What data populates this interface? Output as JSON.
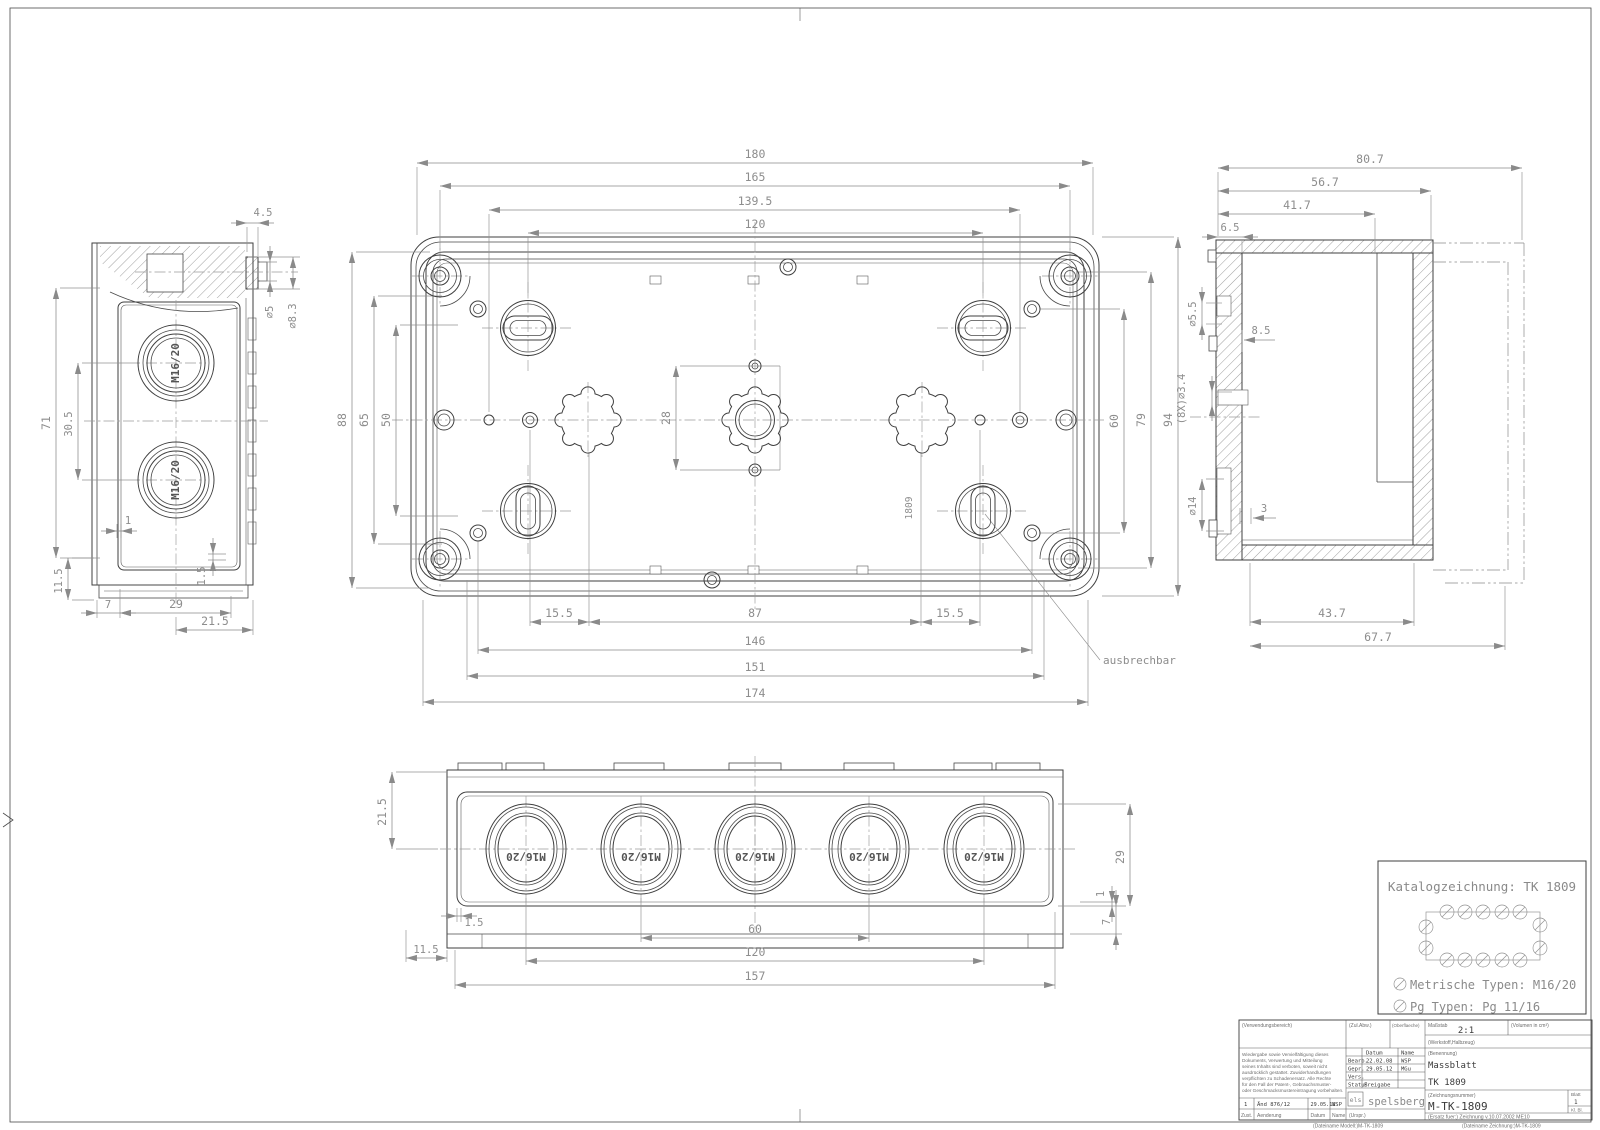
{
  "drawing_type": "dimensioned technical drawing (Massblatt) of enclosure TK 1809",
  "dims": {
    "tv_180": "180",
    "tv_165": "165",
    "tv_139_5": "139.5",
    "tv_120": "120",
    "tv_88": "88",
    "tv_65": "65",
    "tv_50": "50",
    "tv_28": "28",
    "tv_60": "60",
    "tv_79": "79",
    "tv_94": "94",
    "tv_15_5a": "15.5",
    "tv_87": "87",
    "tv_15_5b": "15.5",
    "tv_146": "146",
    "tv_151": "151",
    "tv_174": "174",
    "lv_4_5": "4.5",
    "lv_dia5": "∅5",
    "lv_dia8_3": "∅8.3",
    "lv_71": "71",
    "lv_30_5": "30.5",
    "lv_1": "1",
    "lv_1_5": "1.5",
    "lv_11_5": "11.5",
    "lv_7": "7",
    "lv_29": "29",
    "lv_21_5": "21.5",
    "rv_80_7": "80.7",
    "rv_56_7": "56.7",
    "rv_41_7": "41.7",
    "rv_6_5": "6.5",
    "rv_dia5_5": "∅5.5",
    "rv_8_5": "8.5",
    "rv_dia3_4": "(8X)∅3.4",
    "rv_dia14": "∅14",
    "rv_3": "3",
    "rv_43_7": "43.7",
    "rv_67_7": "67.7",
    "bv_21_5": "21.5",
    "bv_29": "29",
    "bv_1": "1",
    "bv_7": "7",
    "bv_1_5": "1.5",
    "bv_11_5": "11.5",
    "bv_60": "60",
    "bv_120": "120",
    "bv_157": "157"
  },
  "labels": {
    "m16": "M16/20",
    "ausbrechbar": "ausbrechbar",
    "stamp": "1809"
  },
  "catalog": {
    "title": "Katalogzeichnung: TK 1809",
    "metric": "Metrische Typen: M16/20",
    "pg": "Pg Typen: Pg 11/16"
  },
  "tb": {
    "verwendungsbereich": "(Verwendungsbereich)",
    "zul_abw": "(Zul.Abw.)",
    "oberflaeche": "(Oberflaeche)",
    "massstab_label": "Maßstab",
    "massstab_value": "2:1",
    "volumen": "(Volumen in cm³)",
    "werkstoff": "(Werkstoff,Halbzeug)",
    "legal": [
      "Wiedergabe sowie Vervielfältigung dieses",
      "Dokuments, Verwertung und Mitteilung",
      "seines Inhalts sind verboten, soweit nicht",
      "ausdrücklich gestattet. Zuwiderhandlungen",
      "verpflichten zu Schadenersatz. Alle Rechte",
      "für den Fall der Patent-, Gebrauchsmuster-",
      "oder Geschmacksmustereintragung vorbehalten."
    ],
    "datum_h": "Datum",
    "name_h": "Name",
    "bearb": "Bearb.",
    "bearb_datum": "22.02.08",
    "bearb_name": "WSP",
    "gepr": "Gepr.",
    "gepr_datum": "29.05.12",
    "gepr_name": "MGu",
    "vers": "Vers.",
    "status": "Status",
    "freigabe": "Freigabe",
    "logo_mark": "els",
    "logo": "spelsberg",
    "urspr": "(Urspr.)",
    "benennung_label": "(Benennung)",
    "benennung1": "Massblatt",
    "benennung2": "TK 1809",
    "zeichnr_label": "(Zeichnungsnummer)",
    "zeichnr": "M-TK-1809",
    "blatt_label": "Blatt",
    "blatt_value": "1",
    "kl_bl": "Kl.  Bl.",
    "ersatz": "(Ersatz fuer:) Zeichnung v.10.07.2002 ME10",
    "rev_zust": "1",
    "rev_text": "Änd 876/12",
    "rev_datum": "29.05.12",
    "rev_name": "WSP",
    "zust_h": "Zust.",
    "aenderung_h": "Aenderung",
    "datum_h2": "Datum",
    "name_h2": "Name",
    "file_model": "(Dateiname Modell:)M-TK-1809",
    "file_drawing": "(Dateiname Zeichnung:)M-TK-1809"
  },
  "colors": {
    "line": "#3f3f3f",
    "dim": "#8a8a8a",
    "background": "#ffffff"
  }
}
